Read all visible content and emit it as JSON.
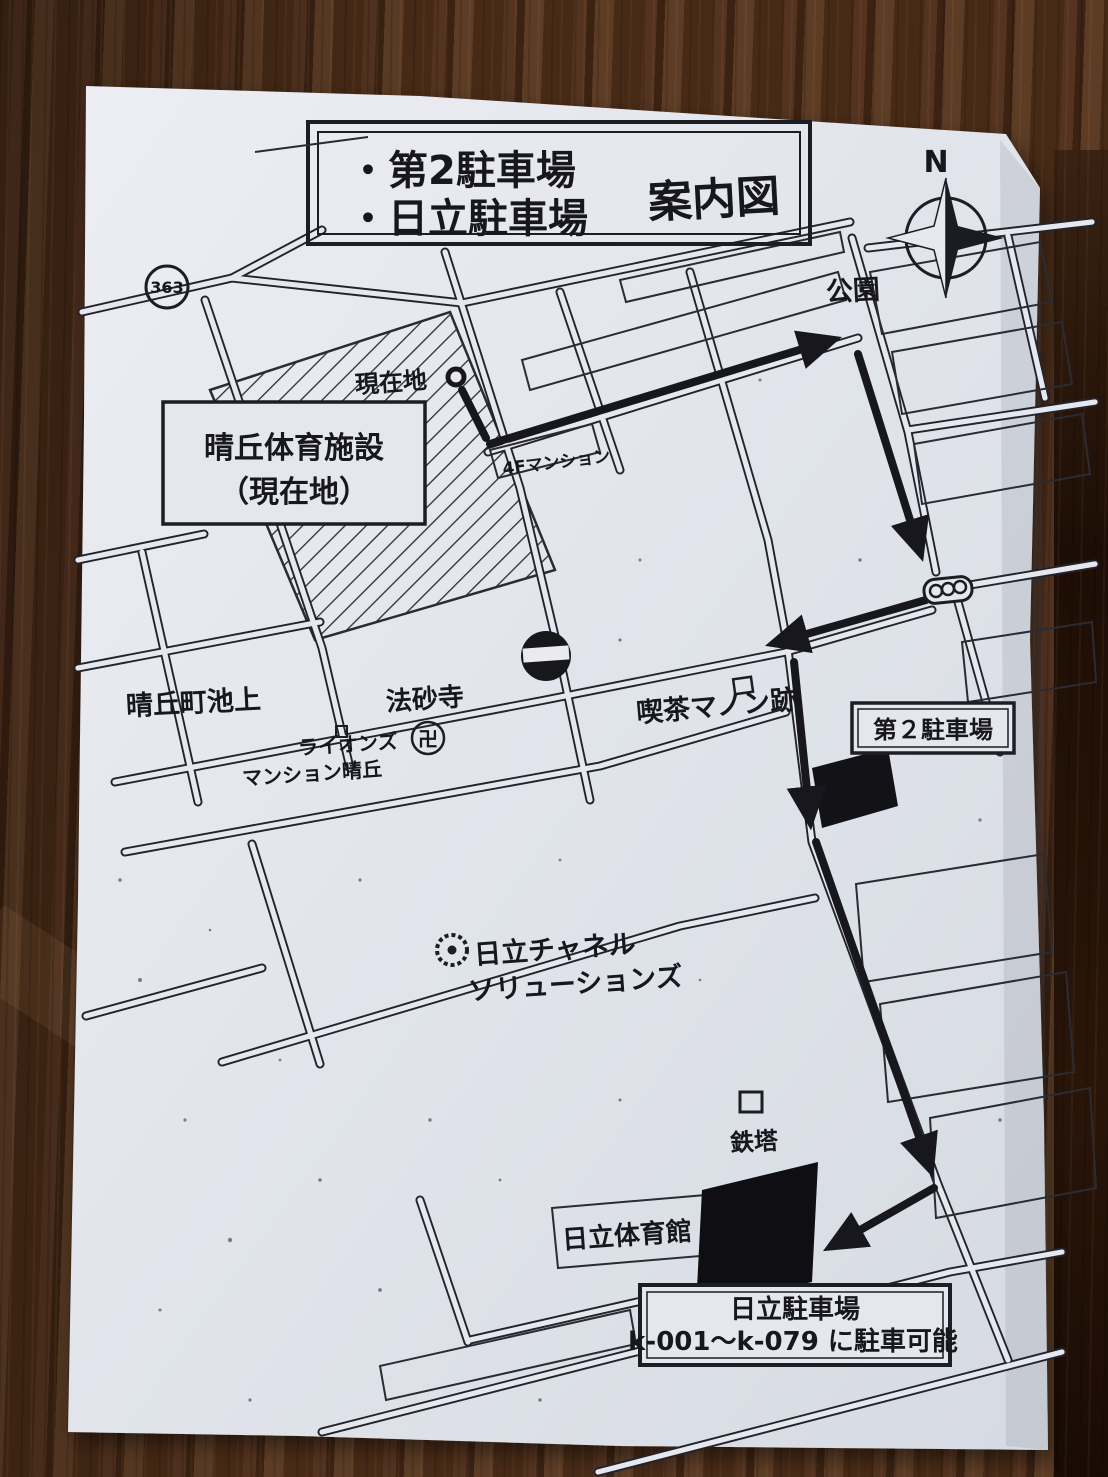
{
  "photo": {
    "scene": "printed guide map photographed on wooden table"
  },
  "colors": {
    "paper": "#e3e6ec",
    "ink": "#17171d",
    "wood": "#4a2c18"
  },
  "title": {
    "line1": "・第2駐車場",
    "line2": "・日立駐車場",
    "suffix": "案内図"
  },
  "compass": {
    "north_label": "N"
  },
  "map": {
    "route_shield": "363",
    "labels": {
      "park": "公園",
      "current_location": "現在地",
      "facility_line1": "晴丘体育施設",
      "facility_line2": "（現在地）",
      "mansion": "4Fマンション",
      "town": "晴丘町池上",
      "temple": "法砂寺",
      "temple_mark": "卍",
      "lions_line1": "ライオンズ",
      "lions_line2": "マンション晴丘",
      "cafe": "喫茶マノン跡",
      "lot2_box": "第２駐車場",
      "hitachi_line1": "日立チャネル",
      "hitachi_line2": "ソリューションズ",
      "tower": "鉄塔",
      "gym": "日立体育館",
      "hitachi_lot_line1": "日立駐車場",
      "hitachi_lot_line2": "k-001～k-079 に駐車可能"
    }
  }
}
